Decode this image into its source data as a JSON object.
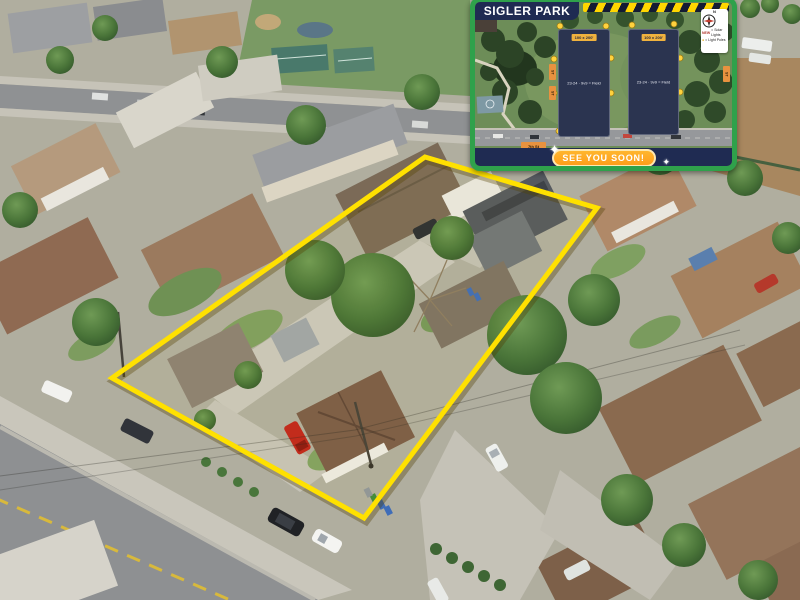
{
  "meta": {
    "image_type": "real-estate aerial drone photo with property boundary overlay and park map inset"
  },
  "colors": {
    "boundary_yellow": "#FFE100",
    "inset_border_green": "#2FA14B",
    "navy": "#1F2B52",
    "badge_yellow": "#F0B23E",
    "pill_fill": "#FFA81F",
    "pill_border": "#FFE8B0",
    "marker_yellow": "#FFD23E",
    "chip_orange": "#E8923F"
  },
  "inset": {
    "title": "SIGLER PARK",
    "banner": {
      "see_you_soon": "SEE YOU SOON!",
      "sparkle": "✦"
    },
    "legend": {
      "north": "N",
      "rows": [
        {
          "prefix": "NEW",
          "label": "= Solar Lights"
        },
        {
          "prefix": "●",
          "label": "= Light Poles"
        }
      ]
    },
    "fields": [
      {
        "badge": "100 x 200'",
        "label": "23-24 · 9v9 = Field"
      },
      {
        "badge": "100 x 200'",
        "label": "23-24 · 9v9 = Field"
      }
    ],
    "chips": {
      "left_top": "ST",
      "left_bottom": "ST",
      "right": "ST",
      "bottom": "7th St"
    }
  },
  "scene": {
    "boundary_points": "425,157 597,208 364,518 112,378",
    "features": [
      "residential neighborhood",
      "park with tennis courts",
      "dirt lot",
      "diagonal street lower-left",
      "multi-unit property outlined in yellow"
    ],
    "vehicles": [
      {
        "name": "white-sedan",
        "location": "street upper-left",
        "color": "#F2F2EF"
      },
      {
        "name": "dark-sedan",
        "location": "street center",
        "color": "#31343A"
      },
      {
        "name": "black-suv",
        "location": "street lower",
        "color": "#202225"
      },
      {
        "name": "white-hatchback",
        "location": "street lower",
        "color": "#F4F4F1"
      },
      {
        "name": "red-pickup",
        "location": "front driveway of property",
        "color": "#C1271D"
      },
      {
        "name": "white-suv",
        "location": "driveway right of property",
        "color": "#EEF0ED"
      },
      {
        "name": "red-car",
        "location": "right edge",
        "color": "#B5392B"
      },
      {
        "name": "dark-car",
        "location": "property parking court",
        "color": "#2C2F34"
      }
    ]
  }
}
